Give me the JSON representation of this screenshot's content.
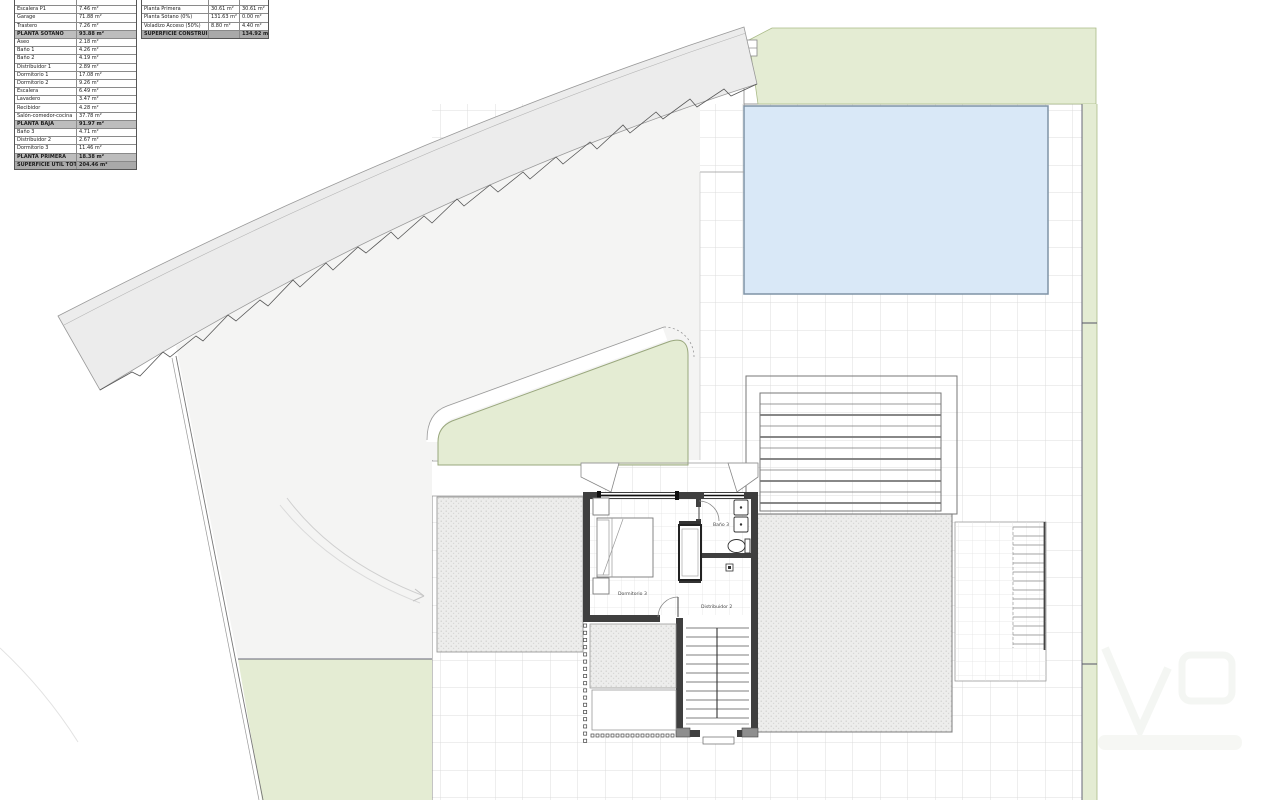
{
  "tables": {
    "left": {
      "rows": [
        {
          "label": "",
          "value": "",
          "cls": ""
        },
        {
          "label": "Escalera P1",
          "value": "7.46 m²",
          "cls": ""
        },
        {
          "label": "Garage",
          "value": "71.88 m²",
          "cls": ""
        },
        {
          "label": "Trastero",
          "value": "7.26 m²",
          "cls": ""
        },
        {
          "label": "PLANTA SÓTANO",
          "value": "93.88 m²",
          "cls": "hdr"
        },
        {
          "label": "Aseo",
          "value": "2.18 m²",
          "cls": ""
        },
        {
          "label": "Baño 1",
          "value": "4.26 m²",
          "cls": ""
        },
        {
          "label": "Baño 2",
          "value": "4.19 m²",
          "cls": ""
        },
        {
          "label": "Distribuidor 1",
          "value": "2.89 m²",
          "cls": ""
        },
        {
          "label": "Dormitorio 1",
          "value": "17.08 m²",
          "cls": ""
        },
        {
          "label": "Dormitorio 2",
          "value": "9.26 m²",
          "cls": ""
        },
        {
          "label": "Escalera",
          "value": "6.49 m²",
          "cls": ""
        },
        {
          "label": "Lavadero",
          "value": "3.47 m²",
          "cls": ""
        },
        {
          "label": "Recibidor",
          "value": "4.28 m²",
          "cls": ""
        },
        {
          "label": "Salón-comedor-cocina",
          "value": "37.78 m²",
          "cls": ""
        },
        {
          "label": "PLANTA BAJA",
          "value": "91.97 m²",
          "cls": "hdr"
        },
        {
          "label": "Baño 3",
          "value": "4.71 m²",
          "cls": ""
        },
        {
          "label": "Distribuidor 2",
          "value": "2.67 m²",
          "cls": ""
        },
        {
          "label": "Dormitorio 3",
          "value": "11.46 m²",
          "cls": ""
        },
        {
          "label": "PLANTA PRIMERA",
          "value": "18.38 m²",
          "cls": "hdr"
        },
        {
          "label": "SUPERFICIE ÚTIL TOTAL",
          "value": "204.46 m²",
          "cls": "tot"
        }
      ]
    },
    "right": {
      "rows": [
        {
          "label": "",
          "v1": "",
          "v2": "",
          "cls": ""
        },
        {
          "label": "Planta Primera",
          "v1": "30.61 m²",
          "v2": "30.61 m²",
          "cls": ""
        },
        {
          "label": "Planta Sótano (0%)",
          "v1": "131.63 m²",
          "v2": "0.00 m²",
          "cls": ""
        },
        {
          "label": "Voladizo Acceso (50%)",
          "v1": "8.80 m²",
          "v2": "4.40 m²",
          "cls": ""
        },
        {
          "label": "SUPERFICIE CONSTRUIDA TOTAL",
          "v1": "",
          "v2": "134.92 m²",
          "cls": "tot"
        }
      ]
    }
  },
  "plan": {
    "labels": {
      "bedroom": "Dormitorio 3",
      "bath": "Baño 3",
      "hall": "Distribuidor 2"
    }
  },
  "colors": {
    "pool": "#d9e8f7",
    "pool_border": "#7f93a6",
    "green": "#e4ecd3",
    "road": "#ececec",
    "plot": "#f4f4f3",
    "grid_line": "#dcdcdc",
    "wall": "#3f3f3f"
  }
}
